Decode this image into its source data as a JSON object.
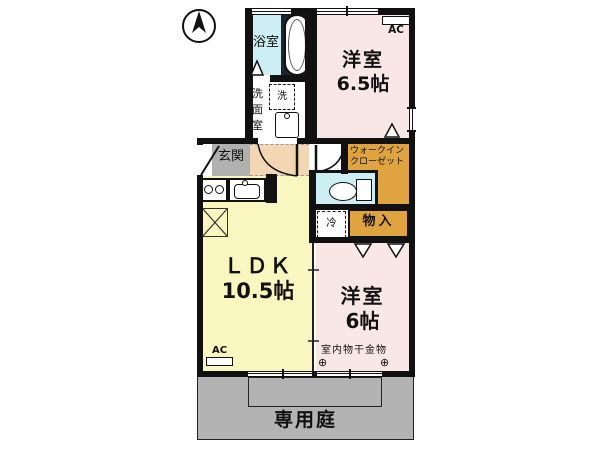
{
  "floorplan": {
    "bathroom": {
      "label": "浴室"
    },
    "washroom": {
      "label": "洗面室",
      "washer": "洗"
    },
    "bedroom_top": {
      "name": "洋室",
      "size": "6.5帖",
      "ac": "AC"
    },
    "entrance": {
      "label": "玄関"
    },
    "wic": {
      "line1": "ウォークイン",
      "line2": "クローゼット"
    },
    "storage": {
      "label": "物入"
    },
    "fridge": {
      "label": "冷"
    },
    "ldk": {
      "name": "ＬＤＫ",
      "size": "10.5帖",
      "ac": "AC"
    },
    "bedroom_bottom": {
      "name": "洋室",
      "size": "6帖",
      "laundry": "室内物干金物",
      "anchor": "⊕"
    },
    "garden": {
      "label": "専用庭"
    },
    "colors": {
      "bedroom": "#f8e7e4",
      "ldk": "#faf6c0",
      "closet": "#dfa440",
      "wet": "#cdeef2",
      "entrance_floor": "#b0b0b0",
      "garden": "#b3b3b3",
      "corridor": "#f3d6b4",
      "wall": "#111111"
    }
  }
}
